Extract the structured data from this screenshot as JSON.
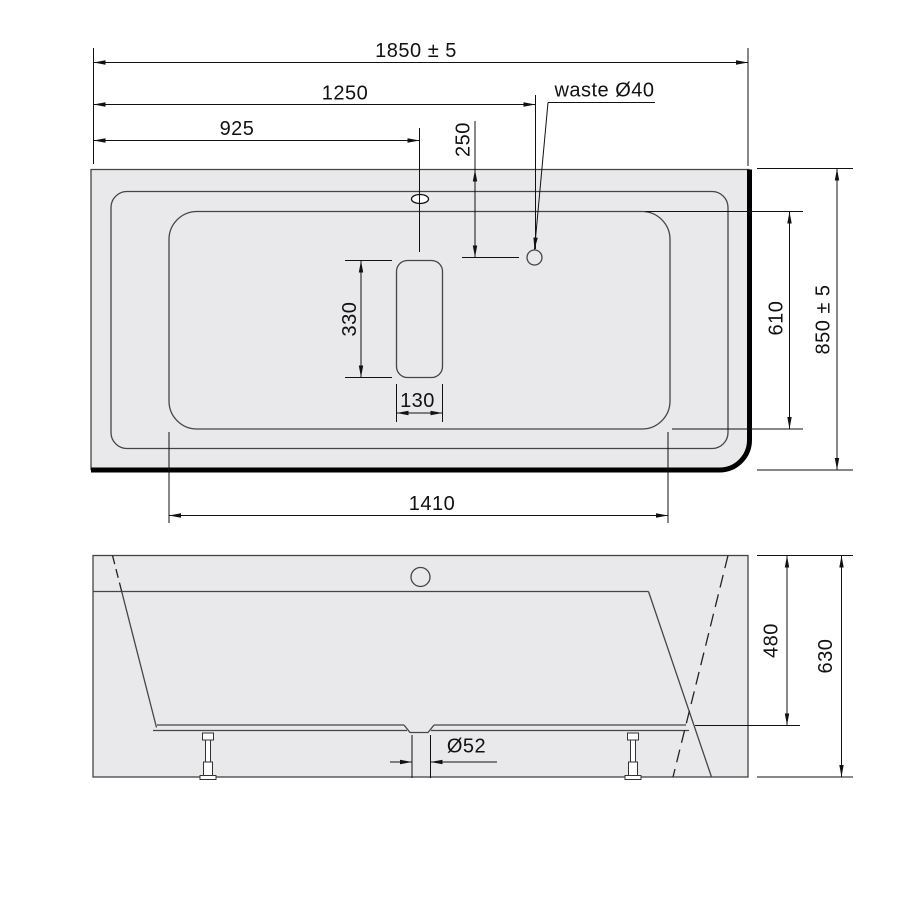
{
  "drawing": {
    "subject": "bathtub-two-view-technical-drawing",
    "colors": {
      "background": "#ffffff",
      "body_fill": "#e9e9eb",
      "outline": "#454545",
      "wall_edge": "#000000",
      "dimension_line": "#111111"
    },
    "top_view": {
      "view_name": "plan-view",
      "dims": {
        "overall_length": "1850 ± 5",
        "waste_x": "1250",
        "overflow_x": "925",
        "waste_y": "250",
        "waste_label": "waste Ø40",
        "overall_width": "850 ± 5",
        "basin_width": "610",
        "seat_length": "330",
        "seat_width": "130",
        "basin_length": "1410"
      }
    },
    "front_view": {
      "view_name": "front-elevation",
      "dims": {
        "inner_depth": "480",
        "overall_height": "630",
        "waste_diameter": "Ø52"
      }
    }
  }
}
